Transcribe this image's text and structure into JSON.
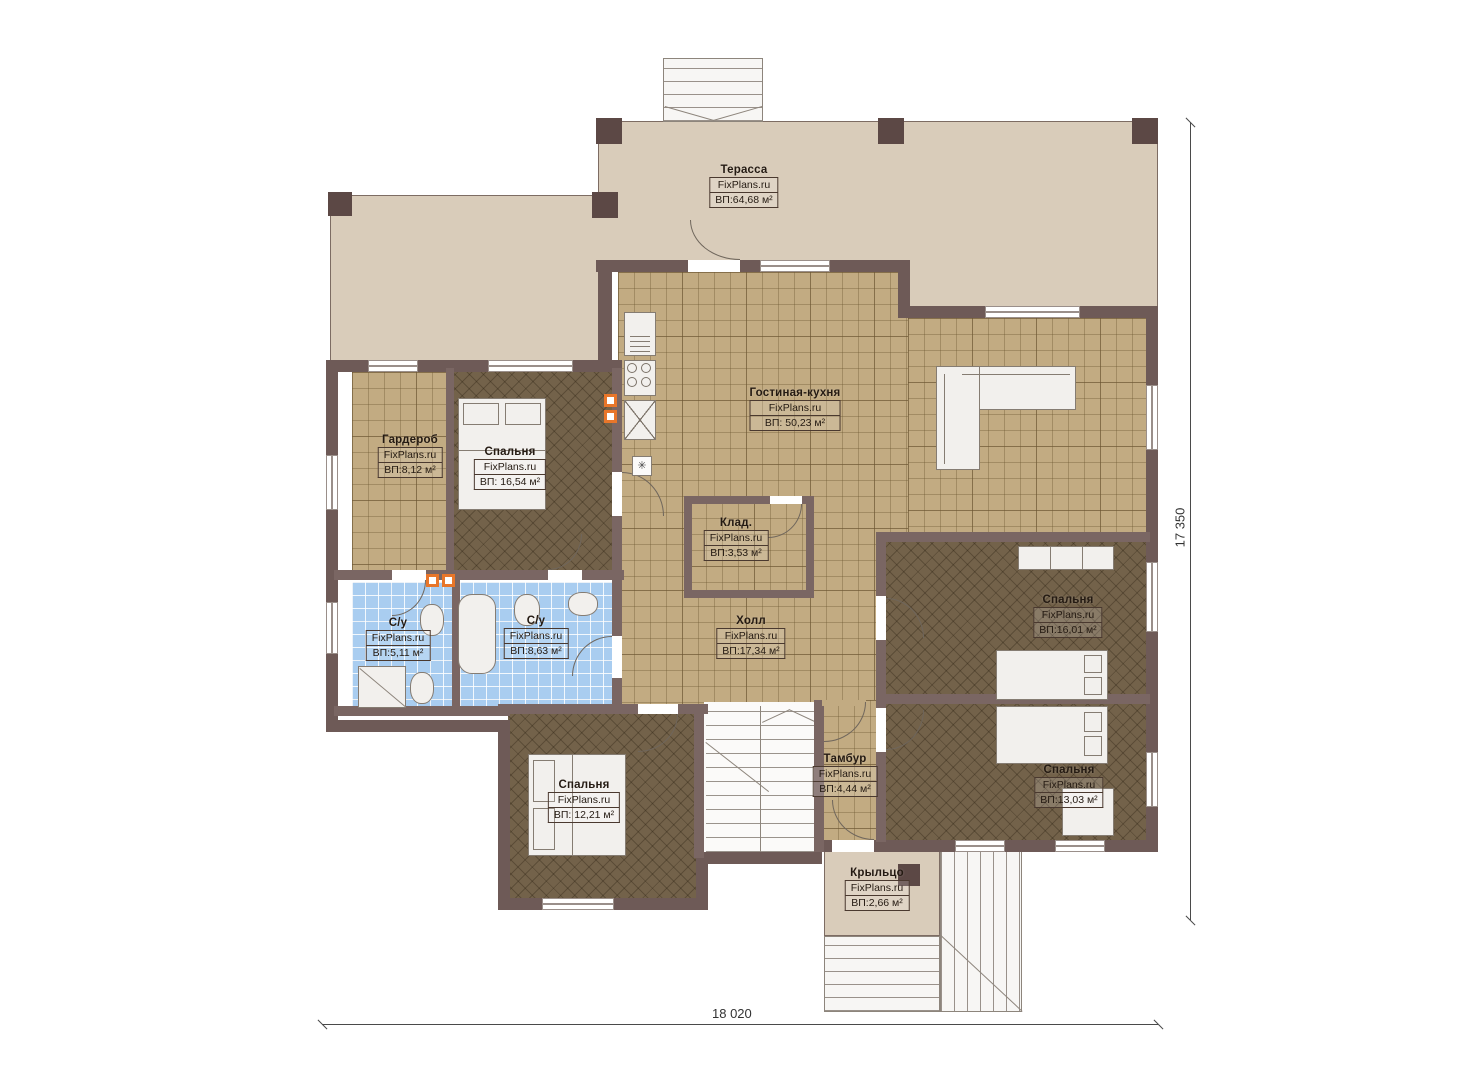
{
  "watermark": "FixPlans.ru",
  "dims": {
    "width_label": "18 020",
    "height_label": "17 350"
  },
  "rooms": [
    {
      "id": "terrace",
      "name": "Терасса",
      "area": "ВП:64,68 м²"
    },
    {
      "id": "living-kitchen",
      "name": "Гостиная-кухня",
      "area": "ВП: 50,23 м²"
    },
    {
      "id": "wardrobe",
      "name": "Гардероб",
      "area": "ВП:8,12 м²"
    },
    {
      "id": "bedroom-1",
      "name": "Спальня",
      "area": "ВП: 16,54 м²"
    },
    {
      "id": "storage",
      "name": "Клад.",
      "area": "ВП:3,53 м²"
    },
    {
      "id": "bathroom-1",
      "name": "С/у",
      "area": "ВП:5,11 м²"
    },
    {
      "id": "bathroom-2",
      "name": "С/у",
      "area": "ВП:8,63 м²"
    },
    {
      "id": "hall",
      "name": "Холл",
      "area": "ВП:17,34 м²"
    },
    {
      "id": "bedroom-2",
      "name": "Спальня",
      "area": "ВП:16,01 м²"
    },
    {
      "id": "bedroom-3",
      "name": "Спальня",
      "area": "ВП:13,03 м²"
    },
    {
      "id": "bedroom-4",
      "name": "Спальня",
      "area": "ВП: 12,21 м²"
    },
    {
      "id": "tambour",
      "name": "Тамбур",
      "area": "ВП:4,44 м²"
    },
    {
      "id": "porch",
      "name": "Крыльцо",
      "area": "ВП:2,66 м²"
    }
  ],
  "colors": {
    "wall": "#6e5a57",
    "terrace_floor": "#d9ccba",
    "tile_floor": "#c2ab82",
    "bedroom_floor": "#73624a",
    "bath_tile": "#a9cdf0",
    "vent_accent": "#e8762a"
  }
}
